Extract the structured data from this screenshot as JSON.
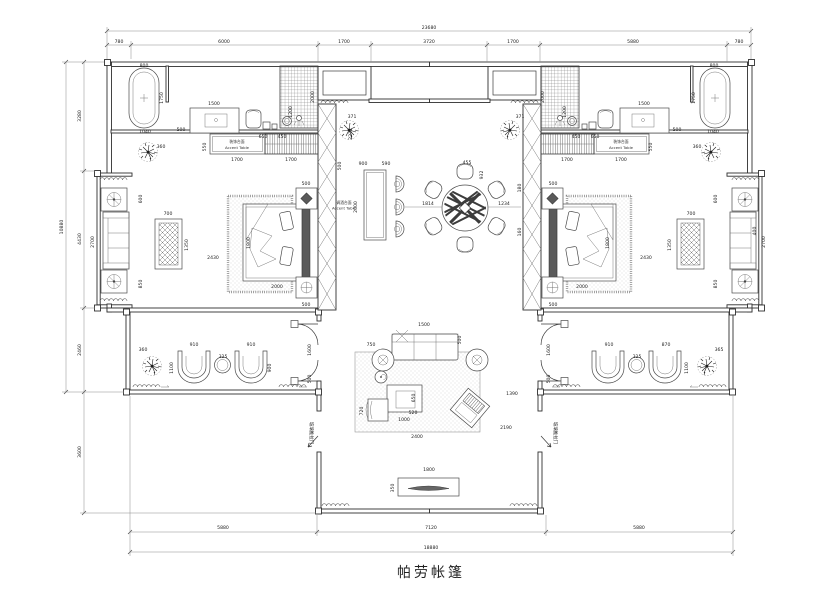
{
  "title": {
    "text": "帕劳帐篷"
  },
  "labels": {
    "accent_left_zh": "装饰台面",
    "accent_left_en": "Accent Table",
    "accent_right_zh": "装饰台面",
    "accent_right_en": "Accent Table",
    "bar_zh": "调酒台面",
    "bar_en": "Accent Table"
  },
  "colors": {
    "line": "#2f2f2f",
    "background": "#ffffff"
  },
  "dim_labels": [
    {
      "t": "23680",
      "x": 429,
      "y": 29
    },
    {
      "t": "780",
      "x": 119,
      "y": 43
    },
    {
      "t": "6000",
      "x": 224,
      "y": 43
    },
    {
      "t": "1700",
      "x": 344,
      "y": 43
    },
    {
      "t": "3720",
      "x": 429,
      "y": 43
    },
    {
      "t": "1700",
      "x": 513,
      "y": 43
    },
    {
      "t": "5880",
      "x": 633,
      "y": 43
    },
    {
      "t": "780",
      "x": 739,
      "y": 43
    },
    {
      "t": "5880",
      "x": 223,
      "y": 529
    },
    {
      "t": "7120",
      "x": 431,
      "y": 529
    },
    {
      "t": "5880",
      "x": 639,
      "y": 529
    },
    {
      "t": "18880",
      "x": 431,
      "y": 549
    },
    {
      "t": "10880",
      "x": 63,
      "y": 227,
      "r": -90
    },
    {
      "t": "3280",
      "x": 81,
      "y": 116,
      "r": -90
    },
    {
      "t": "4430",
      "x": 81,
      "y": 239,
      "r": -90
    },
    {
      "t": "2460",
      "x": 81,
      "y": 350,
      "r": -90
    },
    {
      "t": "3600",
      "x": 81,
      "y": 452,
      "r": -90
    },
    {
      "t": "800",
      "x": 144,
      "y": 67
    },
    {
      "t": "1750",
      "x": 163,
      "y": 98,
      "r": -90
    },
    {
      "t": "1040",
      "x": 145,
      "y": 133
    },
    {
      "t": "1500",
      "x": 214,
      "y": 105
    },
    {
      "t": "500",
      "x": 181,
      "y": 131
    },
    {
      "t": "650",
      "x": 263,
      "y": 138
    },
    {
      "t": "450",
      "x": 282,
      "y": 138
    },
    {
      "t": "2000",
      "x": 314,
      "y": 97,
      "r": -90
    },
    {
      "t": "1200",
      "x": 292,
      "y": 112,
      "r": -90
    },
    {
      "t": "550",
      "x": 206,
      "y": 147,
      "r": -90
    },
    {
      "t": "1700",
      "x": 237,
      "y": 161
    },
    {
      "t": "1700",
      "x": 291,
      "y": 161
    },
    {
      "t": "360",
      "x": 161,
      "y": 148
    },
    {
      "t": "800",
      "x": 714,
      "y": 67
    },
    {
      "t": "1750",
      "x": 695,
      "y": 98,
      "r": -90
    },
    {
      "t": "1040",
      "x": 713,
      "y": 133
    },
    {
      "t": "1500",
      "x": 644,
      "y": 105
    },
    {
      "t": "500",
      "x": 677,
      "y": 131
    },
    {
      "t": "650",
      "x": 595,
      "y": 138
    },
    {
      "t": "450",
      "x": 576,
      "y": 138
    },
    {
      "t": "2000",
      "x": 544,
      "y": 97,
      "r": -90
    },
    {
      "t": "1200",
      "x": 566,
      "y": 112,
      "r": -90
    },
    {
      "t": "550",
      "x": 652,
      "y": 147,
      "r": -90
    },
    {
      "t": "1700",
      "x": 621,
      "y": 161
    },
    {
      "t": "1700",
      "x": 567,
      "y": 161
    },
    {
      "t": "360",
      "x": 697,
      "y": 148
    },
    {
      "t": "2700",
      "x": 94,
      "y": 242,
      "r": -90
    },
    {
      "t": "600",
      "x": 142,
      "y": 199,
      "r": -90
    },
    {
      "t": "850",
      "x": 142,
      "y": 284,
      "r": -90
    },
    {
      "t": "2700",
      "x": 765,
      "y": 242,
      "r": -90
    },
    {
      "t": "600",
      "x": 717,
      "y": 199,
      "r": -90
    },
    {
      "t": "850",
      "x": 717,
      "y": 284,
      "r": -90
    },
    {
      "t": "400",
      "x": 756,
      "y": 231,
      "r": -90
    },
    {
      "t": "2430",
      "x": 213,
      "y": 259
    },
    {
      "t": "700",
      "x": 168,
      "y": 215
    },
    {
      "t": "1350",
      "x": 188,
      "y": 245,
      "r": -90
    },
    {
      "t": "1800",
      "x": 250,
      "y": 243,
      "r": -90
    },
    {
      "t": "2000",
      "x": 277,
      "y": 288
    },
    {
      "t": "500",
      "x": 306,
      "y": 185
    },
    {
      "t": "500",
      "x": 306,
      "y": 306
    },
    {
      "t": "2430",
      "x": 646,
      "y": 259
    },
    {
      "t": "700",
      "x": 691,
      "y": 215
    },
    {
      "t": "1350",
      "x": 671,
      "y": 245,
      "r": -90
    },
    {
      "t": "1800",
      "x": 609,
      "y": 243,
      "r": -90
    },
    {
      "t": "2000",
      "x": 582,
      "y": 288
    },
    {
      "t": "500",
      "x": 553,
      "y": 185
    },
    {
      "t": "500",
      "x": 553,
      "y": 306
    },
    {
      "t": "2231",
      "x": 352,
      "y": 134,
      "r": -90
    },
    {
      "t": "500",
      "x": 341,
      "y": 166,
      "r": -90
    },
    {
      "t": "900",
      "x": 363,
      "y": 165
    },
    {
      "t": "590",
      "x": 386,
      "y": 165
    },
    {
      "t": "2000",
      "x": 357,
      "y": 207,
      "r": -90
    },
    {
      "t": "1814",
      "x": 428,
      "y": 205
    },
    {
      "t": "455",
      "x": 467,
      "y": 164
    },
    {
      "t": "932",
      "x": 483,
      "y": 175,
      "r": -90
    },
    {
      "t": "1234",
      "x": 504,
      "y": 205
    },
    {
      "t": "180",
      "x": 521,
      "y": 188,
      "r": -90
    },
    {
      "t": "160",
      "x": 521,
      "y": 232,
      "r": -90
    },
    {
      "t": "371",
      "x": 352,
      "y": 118
    },
    {
      "t": "371",
      "x": 520,
      "y": 118
    },
    {
      "t": "1600",
      "x": 311,
      "y": 350,
      "r": -90
    },
    {
      "t": "500",
      "x": 311,
      "y": 379,
      "r": -90
    },
    {
      "t": "910",
      "x": 194,
      "y": 346
    },
    {
      "t": "910",
      "x": 251,
      "y": 346
    },
    {
      "t": "325",
      "x": 223,
      "y": 358
    },
    {
      "t": "1100",
      "x": 173,
      "y": 368,
      "r": -90
    },
    {
      "t": "900",
      "x": 271,
      "y": 368,
      "r": -90
    },
    {
      "t": "360",
      "x": 143,
      "y": 351
    },
    {
      "t": "1600",
      "x": 550,
      "y": 350,
      "r": -90
    },
    {
      "t": "500",
      "x": 550,
      "y": 379,
      "r": -90
    },
    {
      "t": "910",
      "x": 609,
      "y": 346
    },
    {
      "t": "870",
      "x": 666,
      "y": 346
    },
    {
      "t": "325",
      "x": 637,
      "y": 358
    },
    {
      "t": "1100",
      "x": 688,
      "y": 368,
      "r": -90
    },
    {
      "t": "365",
      "x": 719,
      "y": 351
    },
    {
      "t": "1500",
      "x": 424,
      "y": 326
    },
    {
      "t": "500",
      "x": 461,
      "y": 340,
      "r": -90
    },
    {
      "t": "1390",
      "x": 512,
      "y": 395
    },
    {
      "t": "2190",
      "x": 506,
      "y": 429
    },
    {
      "t": "2400",
      "x": 417,
      "y": 438
    },
    {
      "t": "1000",
      "x": 404,
      "y": 421
    },
    {
      "t": "520",
      "x": 413,
      "y": 414
    },
    {
      "t": "650",
      "x": 415,
      "y": 398,
      "r": -90
    },
    {
      "t": "720",
      "x": 363,
      "y": 411,
      "r": -90
    },
    {
      "t": "750",
      "x": 371,
      "y": 346
    },
    {
      "t": "1800",
      "x": 429,
      "y": 471
    },
    {
      "t": "350",
      "x": 394,
      "y": 488,
      "r": -90
    },
    {
      "t": "玻璃推拉门",
      "x": 310,
      "y": 433,
      "r": 90,
      "cjk": true
    },
    {
      "t": "玻璃推拉门",
      "x": 554,
      "y": 433,
      "r": 90,
      "cjk": true
    }
  ]
}
